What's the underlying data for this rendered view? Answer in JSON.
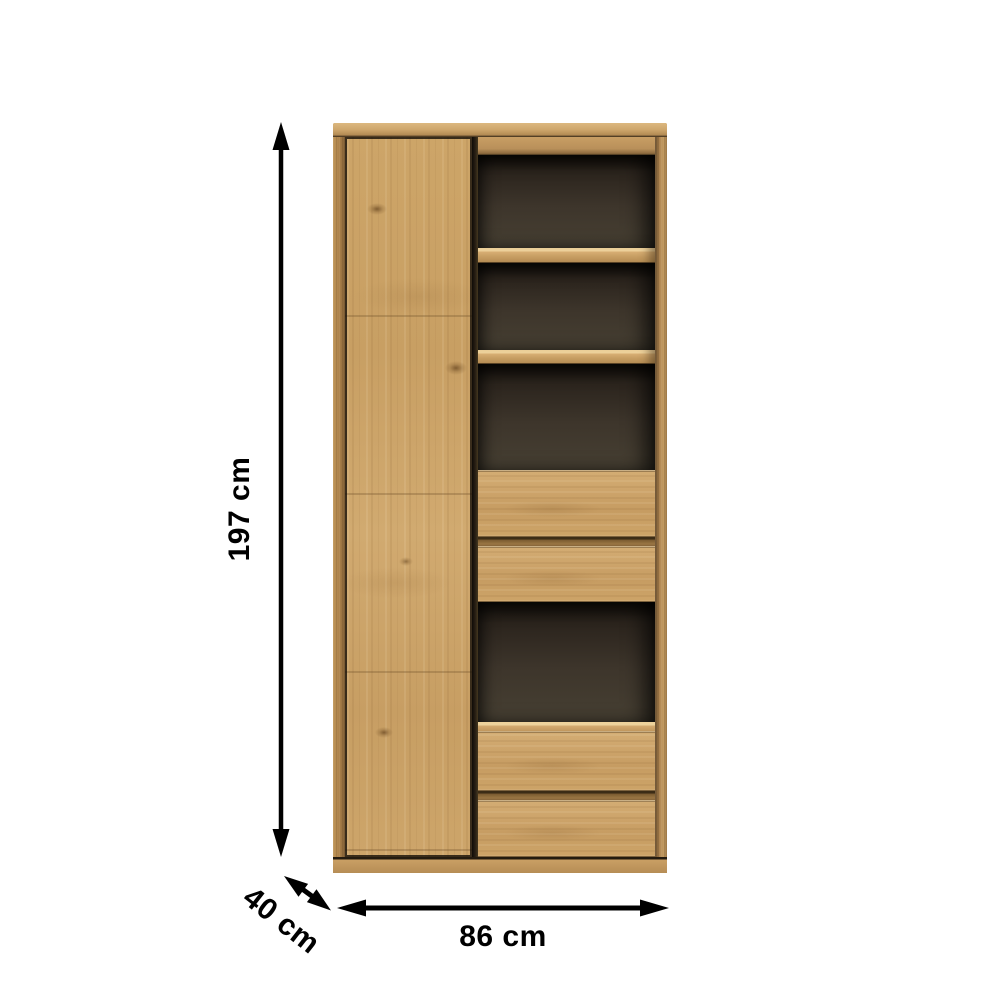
{
  "scene": {
    "type": "product-dimension-diagram",
    "background": "#ffffff",
    "product_description": "Tall oak cabinet with one left-hand door, dark-backed open shelf compartments and four drawers"
  },
  "dimensions": {
    "height": {
      "label": "197 cm",
      "value_cm": 197,
      "axis": "vertical"
    },
    "width": {
      "label": "86 cm",
      "value_cm": 86,
      "axis": "horizontal"
    },
    "depth": {
      "label": "40 cm",
      "value_cm": 40,
      "axis": "diagonal"
    }
  },
  "annotation": {
    "arrow_color": "#000000",
    "text_color": "#000000",
    "style": "double-headed arrows"
  },
  "cabinet": {
    "wood_color": "#c79e66",
    "wood_light": "#e9cb92",
    "wood_dark": "#9b7645",
    "interior_color": "#3d352b",
    "interior_shadow": "#16120d",
    "doors": 1,
    "open_compartments": 4,
    "shelf_boards": 2,
    "drawers": 4
  }
}
